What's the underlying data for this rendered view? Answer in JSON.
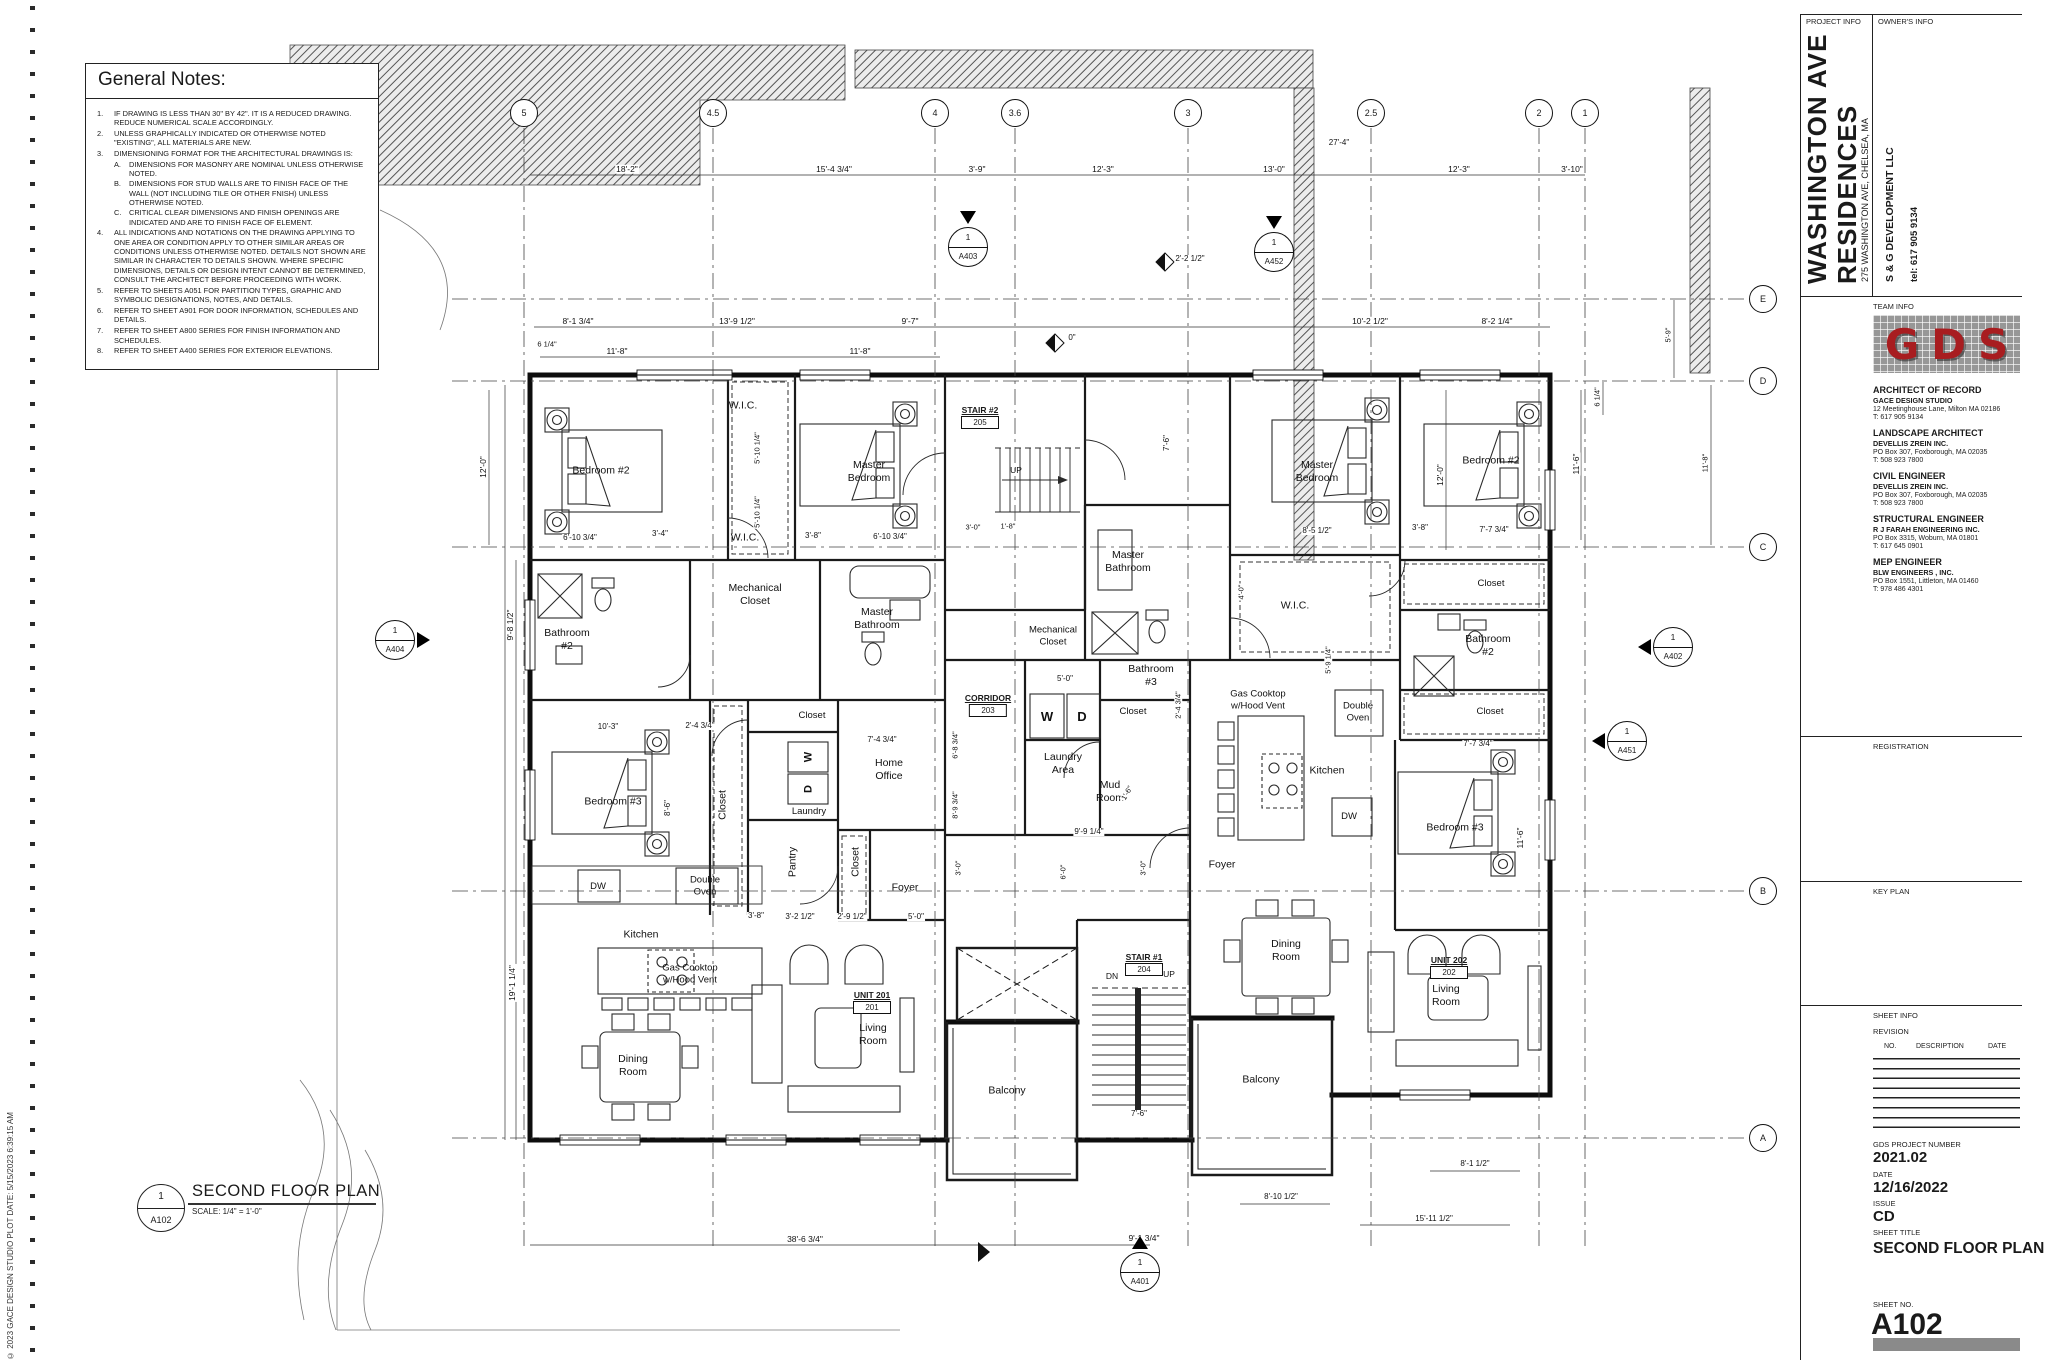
{
  "sheet": {
    "copyright": "© 2023 GACE DESIGN STUDIO      PLOT DATE: 5/15/2023 6:39:15 AM",
    "plan_title": {
      "detail_no": "1",
      "sheet_ref": "A102",
      "title": "SECOND FLOOR PLAN",
      "scale": "SCALE:    1/4\" = 1'-0\""
    },
    "title_block": {
      "project_info_label": "PROJECT INFO",
      "owners_info_label": "OWNER'S INFO",
      "project_name_line1": "WASHINGTON AVE",
      "project_name_line2": "RESIDENCES",
      "project_address": "275 WASHINGTON AVE, CHELSEA, MA",
      "owner_name": "S & G DEVELOPMENT LLC",
      "owner_tel": "tel: 617 905 9134",
      "team_info_label": "TEAM INFO",
      "logo_text": "GDS",
      "logo_color": "#a81d20",
      "team": [
        {
          "role": "ARCHITECT OF RECORD",
          "firm": "GACE DESIGN STUDIO",
          "address": "12 Meetinghouse Lane, Milton MA 02186",
          "tel": "T: 617 905 9134"
        },
        {
          "role": "LANDSCAPE ARCHITECT",
          "firm": "DEVELLIS ZREIN INC.",
          "address": "PO Box 307, Foxborough, MA 02035",
          "tel": "T: 508 923 7800"
        },
        {
          "role": "CIVIL ENGINEER",
          "firm": "DEVELLIS ZREIN INC.",
          "address": "PO Box 307, Foxborough, MA 02035",
          "tel": "T: 508 923 7800"
        },
        {
          "role": "STRUCTURAL ENGINEER",
          "firm": "R J FARAH ENGINEERING INC.",
          "address": "PO Box 3315, Woburn, MA 01801",
          "tel": "T: 617 645 0901"
        },
        {
          "role": "MEP ENGINEER",
          "firm": "BLW ENGINEERS , INC.",
          "address": "PO Box 1551, Littleton, MA 01460",
          "tel": "T: 978 486 4301"
        }
      ],
      "registration_label": "REGISTRATION",
      "key_plan_label": "KEY PLAN",
      "sheet_info_label": "SHEET INFO",
      "revision_label": "REVISION",
      "revision_cols": [
        "NO.",
        "DESCRIPTION",
        "DATE"
      ],
      "project_number_label": "GDS PROJECT NUMBER",
      "project_number": "2021.02",
      "date_label": "DATE",
      "date": "12/16/2022",
      "issue_label": "ISSUE",
      "issue": "CD",
      "sheet_title_label": "SHEET TITLE",
      "sheet_title": "SECOND FLOOR PLAN",
      "sheet_no_label": "SHEET NO.",
      "sheet_no": "A102"
    }
  },
  "general_notes": {
    "title": "General Notes:",
    "notes": [
      {
        "no": "1.",
        "text": "IF DRAWING IS LESS THAN 30\" BY 42\".  IT IS A REDUCED DRAWING.  REDUCE NUMERICAL SCALE ACCORDINGLY."
      },
      {
        "no": "2.",
        "text": "UNLESS GRAPHICALLY INDICATED OR OTHERWISE NOTED \"EXISTING\", ALL MATERIALS ARE NEW."
      },
      {
        "no": "3.",
        "text": "DIMENSIONING FORMAT FOR THE ARCHITECTURAL DRAWINGS IS:",
        "sub": [
          {
            "no": "A.",
            "text": "DIMENSIONS FOR MASONRY ARE NOMINAL UNLESS OTHERWISE NOTED."
          },
          {
            "no": "B.",
            "text": "DIMENSIONS FOR STUD WALLS ARE TO FINISH FACE OF THE WALL (NOT INCLUDING TILE OR OTHER FNISH) UNLESS OTHERWISE NOTED."
          },
          {
            "no": "C.",
            "text": "CRITICAL CLEAR DIMENSIONS AND FINISH OPENINGS ARE INDICATED AND ARE TO FINISH FACE OF ELEMENT."
          }
        ]
      },
      {
        "no": "4.",
        "text": "ALL INDICATIONS AND NOTATIONS ON THE DRAWING APPLYING TO ONE AREA OR CONDITION APPLY TO OTHER SIMILAR AREAS OR CONDITIONS UNLESS OTHERWISE NOTED.  DETAILS NOT SHOWN ARE SIMILAR IN CHARACTER TO DETAILS SHOWN.  WHERE SPECIFIC DIMENSIONS, DETAILS OR DESIGN INTENT CANNOT BE DETERMINED, CONSULT THE ARCHITECT BEFORE PROCEEDING WITH WORK."
      },
      {
        "no": "5.",
        "text": "REFER TO SHEETS A051 FOR PARTITION TYPES, GRAPHIC AND SYMBOLIC DESIGNATIONS, NOTES, AND DETAILS."
      },
      {
        "no": "6.",
        "text": "REFER TO SHEET A901 FOR DOOR INFORMATION, SCHEDULES AND DETAILS."
      },
      {
        "no": "7.",
        "text": "REFER TO SHEET A800 SERIES FOR FINISH INFORMATION AND SCHEDULES."
      },
      {
        "no": "8.",
        "text": "REFER TO SHEET A400 SERIES FOR EXTERIOR ELEVATIONS."
      }
    ]
  },
  "plan": {
    "grid_cols": [
      {
        "label": "5",
        "x": 524
      },
      {
        "label": "4.5",
        "x": 713
      },
      {
        "label": "4",
        "x": 935
      },
      {
        "label": "3.6",
        "x": 1015
      },
      {
        "label": "3",
        "x": 1188
      },
      {
        "label": "2.5",
        "x": 1371
      },
      {
        "label": "2",
        "x": 1539
      },
      {
        "label": "1",
        "x": 1585
      }
    ],
    "grid_rows": [
      {
        "label": "E",
        "y": 299
      },
      {
        "label": "D",
        "y": 381
      },
      {
        "label": "C",
        "y": 547
      },
      {
        "label": "B",
        "y": 891
      },
      {
        "label": "A",
        "y": 1138
      }
    ],
    "tags": [
      {
        "name": "STAIR #2",
        "num": "205",
        "x": 980,
        "y": 405
      },
      {
        "name": "CORRIDOR",
        "num": "203",
        "x": 988,
        "y": 693
      },
      {
        "name": "STAIR #1",
        "num": "204",
        "x": 1144,
        "y": 952
      },
      {
        "name": "UNIT 201",
        "num": "201",
        "x": 872,
        "y": 990
      },
      {
        "name": "UNIT 202",
        "num": "202",
        "x": 1449,
        "y": 955
      }
    ],
    "markers": [
      {
        "num": "1",
        "sheet": "A404",
        "x": 395,
        "y": 640,
        "tri": "e"
      },
      {
        "num": "1",
        "sheet": "A403",
        "x": 968,
        "y": 247,
        "tri": "n"
      },
      {
        "num": "1",
        "sheet": "A452",
        "x": 1274,
        "y": 252,
        "tri": "n"
      },
      {
        "num": "1",
        "sheet": "A402",
        "x": 1673,
        "y": 647,
        "tri": "w"
      },
      {
        "num": "1",
        "sheet": "A451",
        "x": 1627,
        "y": 741,
        "tri": "w"
      },
      {
        "num": "1",
        "sheet": "A401",
        "x": 1140,
        "y": 1272,
        "tri": "up"
      }
    ],
    "rooms": [
      {
        "lines": [
          "Bedroom #2"
        ],
        "x": 601,
        "y": 471
      },
      {
        "lines": [
          "W.I.C."
        ],
        "x": 743,
        "y": 406
      },
      {
        "lines": [
          "W.I.C."
        ],
        "x": 745,
        "y": 538
      },
      {
        "lines": [
          "Master",
          "Bedroom"
        ],
        "x": 869,
        "y": 472
      },
      {
        "lines": [
          "Bathroom",
          "#2"
        ],
        "x": 567,
        "y": 640
      },
      {
        "lines": [
          "Mechanical",
          "Closet"
        ],
        "x": 755,
        "y": 595
      },
      {
        "lines": [
          "Master",
          "Bathroom"
        ],
        "x": 877,
        "y": 619
      },
      {
        "lines": [
          "Bedroom #3"
        ],
        "x": 613,
        "y": 802
      },
      {
        "lines": [
          "Closet"
        ],
        "x": 723,
        "y": 805,
        "r": -90
      },
      {
        "lines": [
          "Closet"
        ],
        "x": 812,
        "y": 716,
        "fs": 9.5
      },
      {
        "lines": [
          "W"
        ],
        "x": 809,
        "y": 757,
        "r": -90,
        "b": 1,
        "fs": 11
      },
      {
        "lines": [
          "D"
        ],
        "x": 809,
        "y": 789,
        "r": -90,
        "b": 1,
        "fs": 11
      },
      {
        "lines": [
          "Laundry"
        ],
        "x": 809,
        "y": 812,
        "fs": 9.5
      },
      {
        "lines": [
          "Pantry"
        ],
        "x": 793,
        "y": 862,
        "r": -90
      },
      {
        "lines": [
          "Closet"
        ],
        "x": 856,
        "y": 862,
        "r": -90
      },
      {
        "lines": [
          "Home",
          "Office"
        ],
        "x": 889,
        "y": 770
      },
      {
        "lines": [
          "Foyer"
        ],
        "x": 905,
        "y": 888
      },
      {
        "lines": [
          "DW"
        ],
        "x": 598,
        "y": 887,
        "fs": 9.5
      },
      {
        "lines": [
          "Double",
          "Oven"
        ],
        "x": 705,
        "y": 886,
        "fs": 9.5
      },
      {
        "lines": [
          "Kitchen"
        ],
        "x": 641,
        "y": 935
      },
      {
        "lines": [
          "Gas Cooktop",
          "w/Hood Vent"
        ],
        "x": 690,
        "y": 974,
        "fs": 9.5
      },
      {
        "lines": [
          "Dining",
          "Room"
        ],
        "x": 633,
        "y": 1066
      },
      {
        "lines": [
          "Living",
          "Room"
        ],
        "x": 873,
        "y": 1035
      },
      {
        "lines": [
          "Balcony"
        ],
        "x": 1007,
        "y": 1091
      },
      {
        "lines": [
          "UP"
        ],
        "x": 1016,
        "y": 470,
        "fs": 8.5
      },
      {
        "lines": [
          "Mechanical",
          "Closet"
        ],
        "x": 1053,
        "y": 636,
        "fs": 9.5
      },
      {
        "lines": [
          "W"
        ],
        "x": 1047,
        "y": 717,
        "b": 1,
        "fs": 13
      },
      {
        "lines": [
          "D"
        ],
        "x": 1082,
        "y": 717,
        "b": 1,
        "fs": 13
      },
      {
        "lines": [
          "Laundry",
          "Area"
        ],
        "x": 1063,
        "y": 764
      },
      {
        "lines": [
          "Mud",
          "Room"
        ],
        "x": 1110,
        "y": 792
      },
      {
        "lines": [
          "Bathroom",
          "#3"
        ],
        "x": 1151,
        "y": 676
      },
      {
        "lines": [
          "Closet"
        ],
        "x": 1133,
        "y": 712,
        "fs": 9.5
      },
      {
        "lines": [
          "Master",
          "Bathroom"
        ],
        "x": 1128,
        "y": 562
      },
      {
        "lines": [
          "DN"
        ],
        "x": 1112,
        "y": 976,
        "fs": 8.5
      },
      {
        "lines": [
          "UP"
        ],
        "x": 1169,
        "y": 974,
        "fs": 8.5
      },
      {
        "lines": [
          "Foyer"
        ],
        "x": 1222,
        "y": 865
      },
      {
        "lines": [
          "Balcony"
        ],
        "x": 1261,
        "y": 1080
      },
      {
        "lines": [
          "Master",
          "Bedroom"
        ],
        "x": 1317,
        "y": 472
      },
      {
        "lines": [
          "W.I.C."
        ],
        "x": 1295,
        "y": 606
      },
      {
        "lines": [
          "Bedroom #2"
        ],
        "x": 1491,
        "y": 461
      },
      {
        "lines": [
          "Closet"
        ],
        "x": 1491,
        "y": 584,
        "fs": 9.5
      },
      {
        "lines": [
          "Bathroom",
          "#2"
        ],
        "x": 1488,
        "y": 646
      },
      {
        "lines": [
          "Closet"
        ],
        "x": 1490,
        "y": 712,
        "fs": 9.5
      },
      {
        "lines": [
          "Gas Cooktop",
          "w/Hood Vent"
        ],
        "x": 1258,
        "y": 700,
        "fs": 9.5
      },
      {
        "lines": [
          "Double",
          "Oven"
        ],
        "x": 1358,
        "y": 712,
        "fs": 9.5
      },
      {
        "lines": [
          "Kitchen"
        ],
        "x": 1327,
        "y": 771
      },
      {
        "lines": [
          "DW"
        ],
        "x": 1349,
        "y": 817,
        "fs": 9.5
      },
      {
        "lines": [
          "Bedroom #3"
        ],
        "x": 1455,
        "y": 828
      },
      {
        "lines": [
          "Dining",
          "Room"
        ],
        "x": 1286,
        "y": 951
      },
      {
        "lines": [
          "Living",
          "Room"
        ],
        "x": 1446,
        "y": 996
      }
    ],
    "dimensions": [
      {
        "t": "18'-2\"",
        "x": 627,
        "y": 169
      },
      {
        "t": "15'-4 3/4\"",
        "x": 834,
        "y": 169
      },
      {
        "t": "3'-9\"",
        "x": 977,
        "y": 169
      },
      {
        "t": "12'-3\"",
        "x": 1103,
        "y": 169
      },
      {
        "t": "13'-0\"",
        "x": 1274,
        "y": 169
      },
      {
        "t": "12'-3\"",
        "x": 1459,
        "y": 169
      },
      {
        "t": "3'-10\"",
        "x": 1572,
        "y": 169
      },
      {
        "t": "27'-4\"",
        "x": 1339,
        "y": 143,
        "fs": 8
      },
      {
        "t": "8'-1 3/4\"",
        "x": 578,
        "y": 321
      },
      {
        "t": "13'-9 1/2\"",
        "x": 737,
        "y": 321
      },
      {
        "t": "9'-7\"",
        "x": 910,
        "y": 321
      },
      {
        "t": "10'-2 1/2\"",
        "x": 1370,
        "y": 321
      },
      {
        "t": "8'-2 1/4\"",
        "x": 1497,
        "y": 321
      },
      {
        "t": "11'-8\"",
        "x": 617,
        "y": 351
      },
      {
        "t": "11'-8\"",
        "x": 860,
        "y": 351
      },
      {
        "t": "6 1/4\"",
        "x": 547,
        "y": 344,
        "fs": 7.5
      },
      {
        "t": "0\"",
        "x": 1072,
        "y": 338,
        "fs": 8
      },
      {
        "t": "2'-2 1/2\"",
        "x": 1190,
        "y": 259,
        "fs": 8
      },
      {
        "t": "12'-0\"",
        "x": 483,
        "y": 467,
        "r": -90
      },
      {
        "t": "9'-8 1/2\"",
        "x": 510,
        "y": 625,
        "r": -90
      },
      {
        "t": "19'-1 1/4\"",
        "x": 512,
        "y": 983,
        "r": -90
      },
      {
        "t": "6 1/4\"",
        "x": 1597,
        "y": 397,
        "r": -90,
        "fs": 7.5
      },
      {
        "t": "11'-6\"",
        "x": 1576,
        "y": 464,
        "r": -90
      },
      {
        "t": "12'-0\"",
        "x": 1440,
        "y": 475,
        "r": -90
      },
      {
        "t": "7'-6\"",
        "x": 1167,
        "y": 443,
        "r": -90,
        "fs": 8
      },
      {
        "t": "5'-9\"",
        "x": 1668,
        "y": 335,
        "r": -90,
        "fs": 7.5
      },
      {
        "t": "11'-8\"",
        "x": 1705,
        "y": 463,
        "r": -90,
        "fs": 7.5
      },
      {
        "t": "5'-10 1/4\"",
        "x": 757,
        "y": 448,
        "r": -90,
        "fs": 7.5
      },
      {
        "t": "5'-10 1/4\"",
        "x": 757,
        "y": 512,
        "r": -90,
        "fs": 7.5
      },
      {
        "t": "6'-10 3/4\"",
        "x": 580,
        "y": 538,
        "fs": 8
      },
      {
        "t": "3'-4\"",
        "x": 660,
        "y": 534,
        "fs": 8
      },
      {
        "t": "3'-8\"",
        "x": 813,
        "y": 536,
        "fs": 8
      },
      {
        "t": "6'-10 3/4\"",
        "x": 890,
        "y": 537,
        "fs": 8
      },
      {
        "t": "3'-0\"",
        "x": 973,
        "y": 527,
        "fs": 7.5
      },
      {
        "t": "1'-8\"",
        "x": 1008,
        "y": 526,
        "fs": 7.5
      },
      {
        "t": "8'-5 1/2\"",
        "x": 1317,
        "y": 531,
        "fs": 8
      },
      {
        "t": "3'-8\"",
        "x": 1420,
        "y": 528,
        "fs": 8
      },
      {
        "t": "7'-7 3/4\"",
        "x": 1494,
        "y": 530,
        "fs": 8
      },
      {
        "t": "10'-3\"",
        "x": 608,
        "y": 727,
        "fs": 8
      },
      {
        "t": "2'-4 3/4\"",
        "x": 700,
        "y": 726,
        "fs": 8
      },
      {
        "t": "7'-4 3/4\"",
        "x": 882,
        "y": 740,
        "fs": 8
      },
      {
        "t": "8'-6\"",
        "x": 668,
        "y": 808,
        "r": -90,
        "fs": 8
      },
      {
        "t": "6'-8 3/4\"",
        "x": 955,
        "y": 745,
        "r": -90,
        "fs": 7.5
      },
      {
        "t": "8'-9 3/4\"",
        "x": 955,
        "y": 805,
        "r": -90,
        "fs": 7.5
      },
      {
        "t": "5'-0\"",
        "x": 1065,
        "y": 679,
        "fs": 8
      },
      {
        "t": "2'-4 3/4\"",
        "x": 1178,
        "y": 705,
        "r": -90,
        "fs": 7.5
      },
      {
        "t": "9'-9 1/4\"",
        "x": 1089,
        "y": 832,
        "fs": 8
      },
      {
        "t": "1'-6\"",
        "x": 1127,
        "y": 793,
        "r": -60,
        "fs": 7.5
      },
      {
        "t": "3'-0\"",
        "x": 958,
        "y": 868,
        "r": -90,
        "fs": 7.5
      },
      {
        "t": "6'-0\"",
        "x": 1063,
        "y": 872,
        "r": -90,
        "fs": 7.5
      },
      {
        "t": "3'-0\"",
        "x": 1143,
        "y": 868,
        "r": -90,
        "fs": 7.5
      },
      {
        "t": "3'-8\"",
        "x": 756,
        "y": 916,
        "fs": 8
      },
      {
        "t": "3'-2 1/2\"",
        "x": 800,
        "y": 917,
        "fs": 8
      },
      {
        "t": "2'-9 1/2\"",
        "x": 852,
        "y": 917,
        "fs": 8
      },
      {
        "t": "5'-0\"",
        "x": 916,
        "y": 917,
        "fs": 8
      },
      {
        "t": "5'-9 1/4\"",
        "x": 1328,
        "y": 660,
        "r": -90,
        "fs": 7.5
      },
      {
        "t": "4'-0\"",
        "x": 1241,
        "y": 592,
        "r": -90,
        "fs": 7.5
      },
      {
        "t": "7'-7 3/4\"",
        "x": 1478,
        "y": 744,
        "fs": 8
      },
      {
        "t": "11'-6\"",
        "x": 1520,
        "y": 838,
        "r": -90
      },
      {
        "t": "7'-6\"",
        "x": 1139,
        "y": 1114,
        "fs": 8
      },
      {
        "t": "8'-1 1/2\"",
        "x": 1475,
        "y": 1164,
        "fs": 8
      },
      {
        "t": "8'-10 1/2\"",
        "x": 1281,
        "y": 1197,
        "fs": 8
      },
      {
        "t": "15'-11 1/2\"",
        "x": 1434,
        "y": 1219,
        "fs": 8
      },
      {
        "t": "38'-6 3/4\"",
        "x": 805,
        "y": 1239
      },
      {
        "t": "9'-1 3/4\"",
        "x": 1144,
        "y": 1238
      }
    ]
  }
}
